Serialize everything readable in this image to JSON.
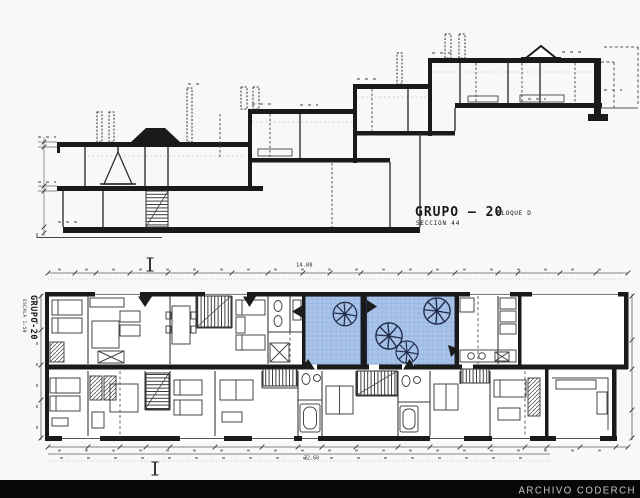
{
  "colors": {
    "paper": "#f8f8f6",
    "plan_bg": "#ffffff",
    "ink": "#1a1a1a",
    "soft": "#3a3a3a",
    "furn": "#474747",
    "dim": "#5f5f5f",
    "blob": "#8e8e8e",
    "patio_fill": "#a9c4e8",
    "patio_grid": "#87a7d9",
    "patio_edge": "#2c3e66",
    "tree": "#222c4a",
    "band_bg": "#070707",
    "band_text": "#c6c6c6"
  },
  "section": {
    "title": "GRUPO — 20",
    "block_label": "BLOQUE D",
    "subtitle": "SECCION 44"
  },
  "plan": {
    "side_title": "GRUPO-20",
    "side_scale": "ESCALA 1:50",
    "dim_top": "14.88",
    "dim_bottom": "32.60"
  },
  "footer": {
    "watermark": "ARCHIVO CODERCH"
  }
}
